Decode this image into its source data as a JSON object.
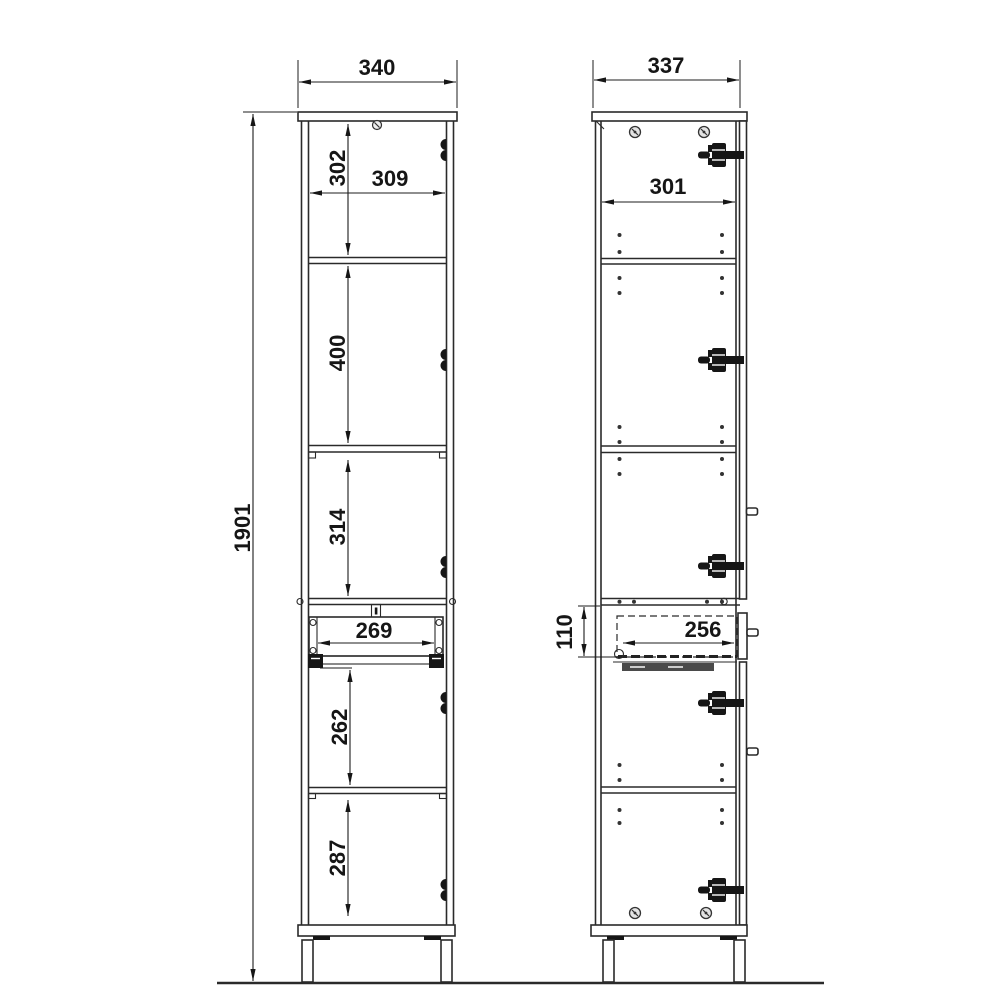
{
  "colors": {
    "line": "#2a2a2a",
    "text": "#161616",
    "background": "#ffffff"
  },
  "front_view": {
    "overall_width": "340",
    "overall_height": "1901",
    "inner_width": "309",
    "top_compartment_height": "302",
    "second_compartment_height": "400",
    "third_compartment_height": "314",
    "drawer_opening_width": "269",
    "fourth_compartment_height": "262",
    "bottom_compartment_height": "287"
  },
  "side_view": {
    "overall_depth": "337",
    "inner_depth": "301",
    "drawer_box_height": "110",
    "drawer_box_depth": "256"
  }
}
